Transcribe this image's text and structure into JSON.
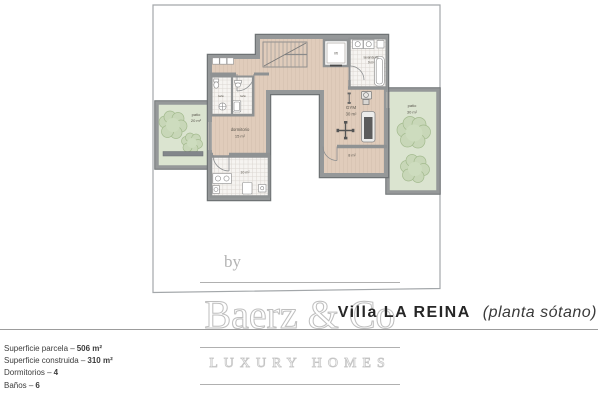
{
  "title": {
    "name": "Villa LA REINA",
    "subtitle": "(planta sótano)"
  },
  "watermark": {
    "prefix": "by",
    "brand": "Baerz & Co",
    "tagline": "LUXURY HOMES"
  },
  "details": {
    "rows": [
      {
        "label": "Superficie parcela –",
        "value": "506 m²"
      },
      {
        "label": "Superficie construida –",
        "value": "310 m²"
      },
      {
        "label": "Dormitorios –",
        "value": "4"
      },
      {
        "label": "Baños –",
        "value": "6"
      }
    ]
  },
  "plan": {
    "rooms": {
      "patio_left": {
        "name": "patio",
        "area": "20 m²"
      },
      "patio_right": {
        "name": "patio",
        "area": "30 m²"
      },
      "dormitorio": {
        "name": "dormitorio",
        "area": "15 m²"
      },
      "gym": {
        "name": "GYM",
        "area": "30 m²"
      },
      "lavanderia": {
        "name": "lavanderia",
        "area": "9 m²"
      },
      "bathroom": {
        "area": "10 m²"
      },
      "storage": {
        "area": "8 m²"
      },
      "lift": {
        "name": "lift"
      },
      "bano_left": {
        "name": "baño"
      },
      "bano_right": {
        "name": "baño"
      }
    },
    "colors": {
      "wall": "#8f9293",
      "wall_edge": "#6f7375",
      "floor": "#e0ccbb",
      "tile": "#f6f4f1",
      "patio": "#dbe4d0",
      "plant": "#c8d7b8",
      "parcel_line": "#a3a7aa"
    }
  }
}
